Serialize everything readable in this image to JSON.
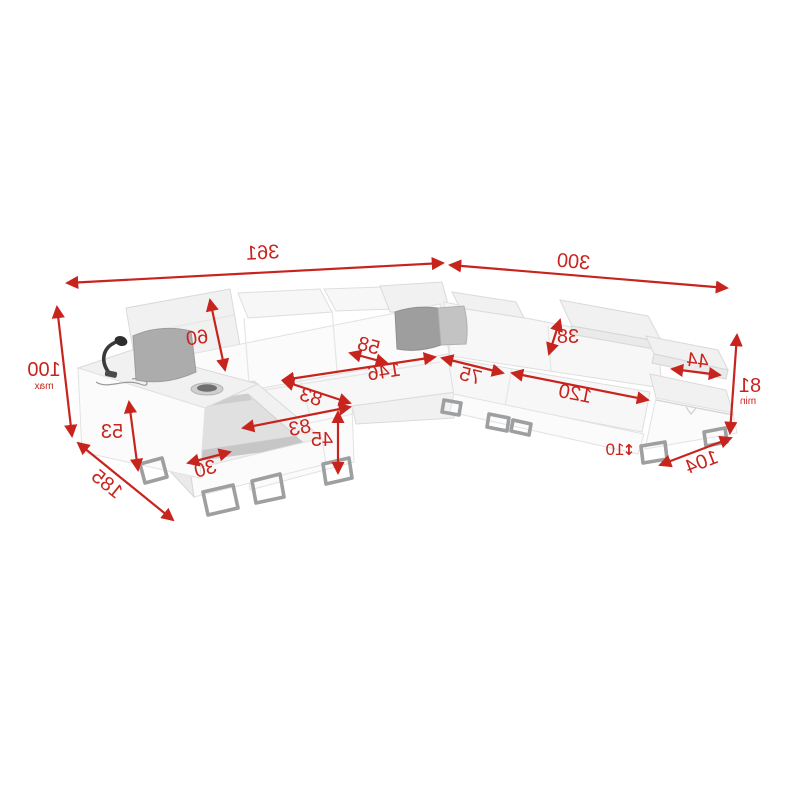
{
  "background_color": "#ffffff",
  "accent_color": "#c8241e",
  "diagram": {
    "subject": "corner-sofa-dimension-diagram",
    "dims": {
      "span_left": "361",
      "span_right": "300",
      "height_max": "100",
      "height_max_note": "max",
      "backrest_height": "60",
      "headrest_depth": "58",
      "bed_length": "146",
      "seat_depth_a": "83",
      "seat_depth_b": "83",
      "bed_front_height": "45",
      "armrest_height": "53",
      "chaise_length": "185",
      "storage_edge": "30",
      "seat_width_small": "75",
      "seat_width_large": "120",
      "headrest_height": "38",
      "armrest_pad_width": "44",
      "height_min": "81",
      "height_min_note": "min",
      "end_depth": "104",
      "leg_height": "10",
      "leg_height_arrow": "↕"
    }
  }
}
